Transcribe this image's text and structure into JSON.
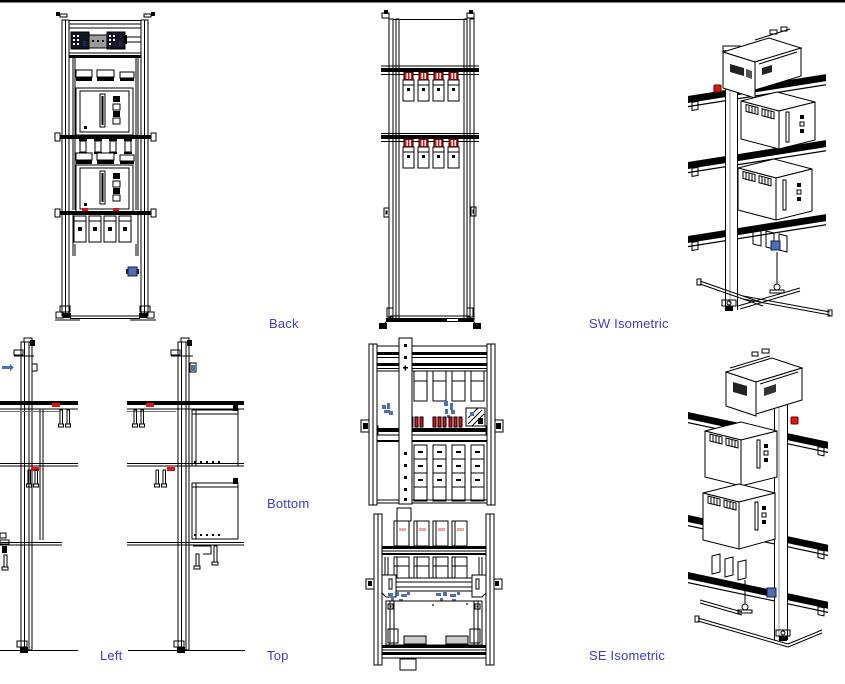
{
  "page": {
    "background_color": "#ffffff",
    "top_border_color": "#000000"
  },
  "drawing": {
    "colors": {
      "line": "#000000",
      "label_text": "#3c3ccc",
      "accent_red": "#e11414",
      "accent_red_faint": "#f0a6a6",
      "accent_blue": "#4a6fb5",
      "module_dark": "#15151f",
      "module_gray": "#9a9a9a",
      "pad_gray": "#cccccc"
    },
    "labels": {
      "back": "Back",
      "sw_isometric": "SW Isometric",
      "left": "Left",
      "bottom": "Bottom",
      "top": "Top",
      "se_isometric": "SE Isometric"
    },
    "module_marking": "E"
  }
}
